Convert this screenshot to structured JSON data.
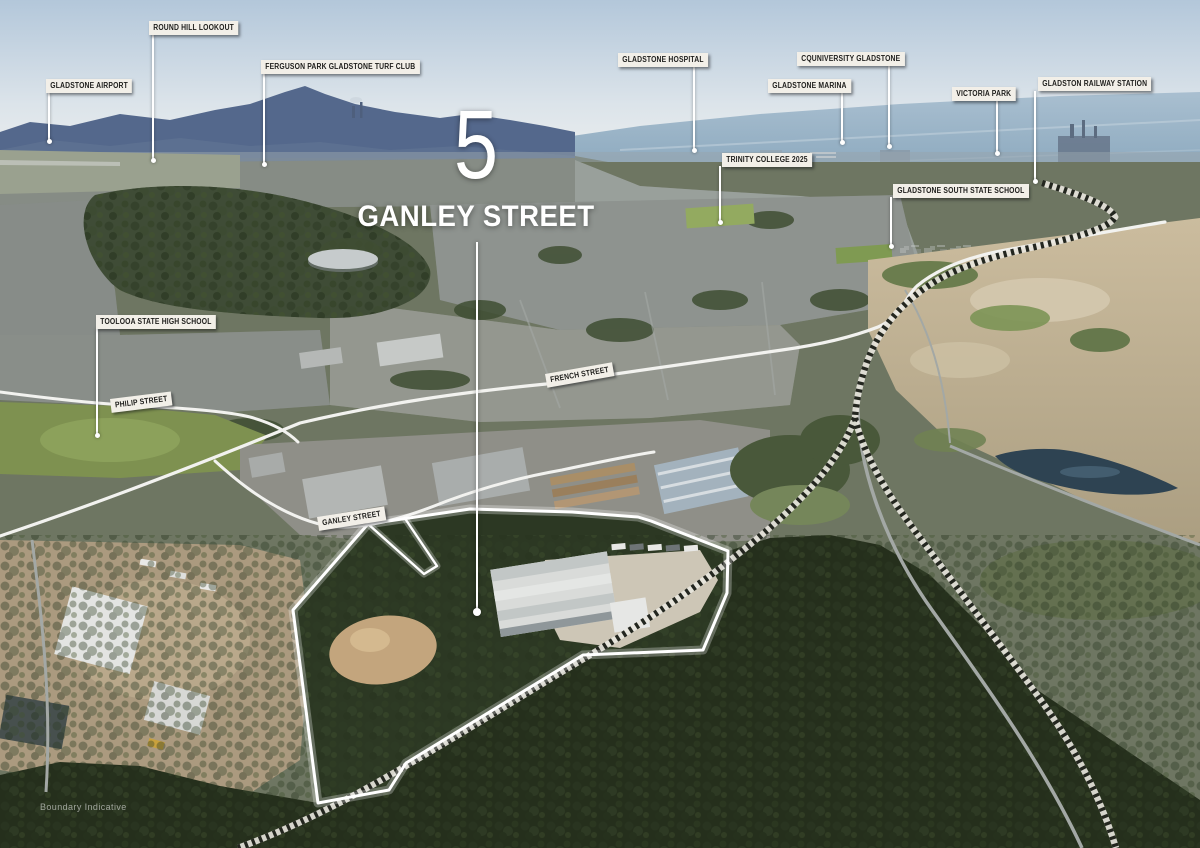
{
  "hero": {
    "number": "5",
    "street": "GANLEY STREET",
    "line": {
      "x": 476,
      "y1": 242,
      "y2": 610
    }
  },
  "notes": {
    "boundary": "Boundary Indicative"
  },
  "colors": {
    "label_bg": "#f2efe8",
    "label_text": "#1d1d1b",
    "leader_line": "#ffffff",
    "boundary_line": "#ffffff",
    "road_line": "#f2f2ef",
    "railway_dash": "#23261f"
  },
  "poi_labels": [
    {
      "id": "gladstone-airport",
      "text": "GLADSTONE AIRPORT",
      "box": {
        "x": 46,
        "y": 79
      },
      "line": {
        "x": 48,
        "y1": 93,
        "y2": 141
      }
    },
    {
      "id": "round-hill-lookout",
      "text": "ROUND HILL LOOKOUT",
      "box": {
        "x": 149,
        "y": 21
      },
      "line": {
        "x": 152,
        "y1": 35,
        "y2": 160
      }
    },
    {
      "id": "ferguson-park-gladstone-turf-club",
      "text": "FERGUSON PARK GLADSTONE TURF CLUB",
      "box": {
        "x": 261,
        "y": 60
      },
      "line": {
        "x": 263,
        "y1": 74,
        "y2": 164
      }
    },
    {
      "id": "gladstone-hospital",
      "text": "GLADSTONE HOSPITAL",
      "box": {
        "x": 618,
        "y": 53
      },
      "line": {
        "x": 693,
        "y1": 67,
        "y2": 150
      }
    },
    {
      "id": "cquniversity-gladstone",
      "text": "CQUNIVERSITY GLADSTONE",
      "box": {
        "x": 797,
        "y": 52
      },
      "line": {
        "x": 888,
        "y1": 66,
        "y2": 146
      }
    },
    {
      "id": "gladstone-marina",
      "text": "GLADSTONE MARINA",
      "box": {
        "x": 768,
        "y": 79
      },
      "line": {
        "x": 841,
        "y1": 93,
        "y2": 142
      }
    },
    {
      "id": "victoria-park",
      "text": "VICTORIA PARK",
      "box": {
        "x": 952,
        "y": 87
      },
      "line": {
        "x": 996,
        "y1": 100,
        "y2": 153
      }
    },
    {
      "id": "gladston-railway-station",
      "text": "GLADSTON RAILWAY STATION",
      "box": {
        "x": 1038,
        "y": 77
      },
      "line": {
        "x": 1034,
        "y1": 91,
        "y2": 181
      }
    },
    {
      "id": "trinity-college-2025",
      "text": "TRINITY COLLEGE 2025",
      "box": {
        "x": 722,
        "y": 153
      },
      "line": {
        "x": 719,
        "y1": 166,
        "y2": 222
      }
    },
    {
      "id": "gladstone-south-state-school",
      "text": "GLADSTONE SOUTH STATE SCHOOL",
      "box": {
        "x": 893,
        "y": 184
      },
      "line": {
        "x": 890,
        "y1": 197,
        "y2": 246
      }
    },
    {
      "id": "toolooa-state-high-school",
      "text": "TOOLOOA STATE HIGH SCHOOL",
      "box": {
        "x": 96,
        "y": 315
      },
      "line": {
        "x": 96,
        "y1": 329,
        "y2": 435
      }
    }
  ],
  "street_labels": [
    {
      "id": "philip-street",
      "text": "PHILIP STREET",
      "x": 110,
      "y": 399,
      "rotate": -7
    },
    {
      "id": "french-street",
      "text": "FRENCH STREET",
      "x": 545,
      "y": 374,
      "rotate": -10
    },
    {
      "id": "ganley-street",
      "text": "GANLEY STREET",
      "x": 317,
      "y": 517,
      "rotate": -9
    }
  ]
}
